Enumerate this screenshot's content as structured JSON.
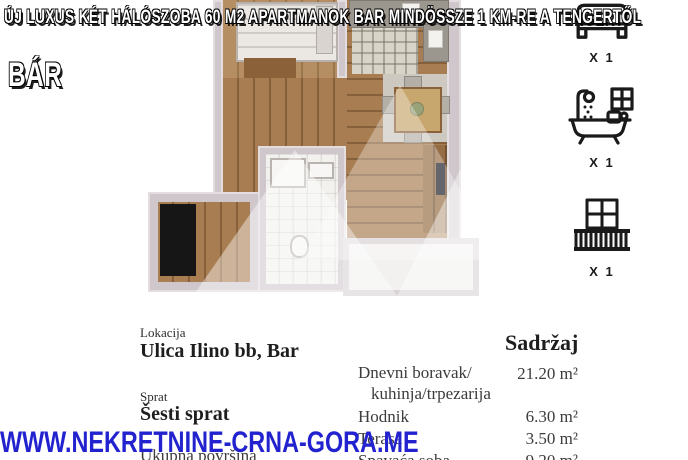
{
  "header": {
    "title": "ÚJ LUXUS KÉT HÁLÓSZOBA 60 M2 APARTMANOK BAR MINDÖSSZE 1 KM-RE A TENGERTŐL",
    "location_tag": "BÁR"
  },
  "features": {
    "bed": {
      "icon": "bed-icon",
      "count": "X 1"
    },
    "bath": {
      "icon": "bath-icon",
      "count": "X 1"
    },
    "balcony": {
      "icon": "balcony-icon",
      "count": "X 1"
    }
  },
  "details": {
    "location_label": "Lokacija",
    "location_value": "Ulica Ilino bb, Bar",
    "floor_label": "Sprat",
    "floor_value": "Šesti sprat",
    "total_area_label": "Ukupna površina"
  },
  "contents": {
    "header": "Sadržaj",
    "rows": [
      {
        "label": "Dnevni boravak/",
        "sublabel": "kuhinja/trpezarija",
        "value": "21.20 m²"
      },
      {
        "label": "Hodnik",
        "value": "6.30 m²"
      },
      {
        "label": "Terasa",
        "value": "3.50 m²"
      },
      {
        "label": "Spavaća soba",
        "value": "9.20 m²"
      }
    ]
  },
  "watermark": "WWW.NEKRETNINE-CRNA-GORA.ME",
  "colors": {
    "watermark_blue": "#2222cf",
    "wood_floor": "#a87d52",
    "wall_grey": "#cfc7cc",
    "icon_black": "#1b1b1b"
  }
}
